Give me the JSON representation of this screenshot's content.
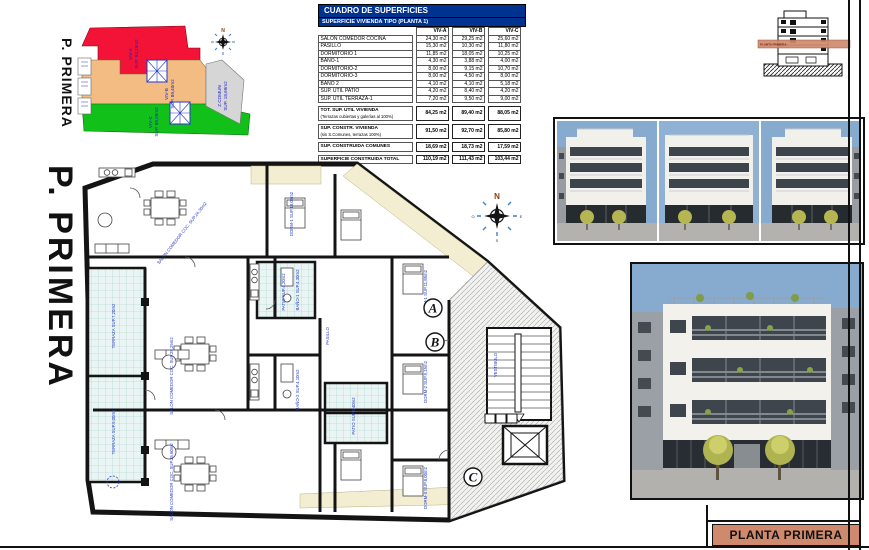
{
  "title_block": {
    "label": "PLANTA PRIMERA"
  },
  "section_thumb": {
    "band_label": "PLANTA PRIMERA"
  },
  "key_plan": {
    "title": "P. PRIMERA",
    "compass_n": "N",
    "zones": [
      {
        "label": "VIV-A",
        "sup": "SUP. 84,25m2",
        "color": "#f31336"
      },
      {
        "label": "VIV-B",
        "sup": "SUP. 89,40m2",
        "color": "#f2bc82"
      },
      {
        "label": "VIV-C",
        "sup": "SUP. 88,05m2",
        "color": "#12c01a"
      },
      {
        "label": "Z.COMUN",
        "sup": "SUP. 18,69m2",
        "color": "#d6d6d6"
      }
    ]
  },
  "areas_table": {
    "title": "CUADRO DE SUPERFICIES",
    "subtitle": "SUPERFICIE VIVIENDA TIPO  (PLANTA 1)",
    "columns": [
      "VIV-A",
      "VIV-B",
      "VIV-C"
    ],
    "rows": [
      {
        "label": "SALON COMEDOR COCINA",
        "a": "24,30 m2",
        "b": "29,25 m2",
        "c": "25,60 m2"
      },
      {
        "label": "PASILLO",
        "a": "15,30 m2",
        "b": "10,30 m2",
        "c": "11,80 m2"
      },
      {
        "label": "DORMITORIO 1",
        "a": "11,85 m2",
        "b": "18,05 m2",
        "c": "10,25 m2"
      },
      {
        "label": "BAÑO-1",
        "a": "4,30 m2",
        "b": "3,88 m2",
        "c": "4,00 m2"
      },
      {
        "label": "DORMITORIO-2",
        "a": "8,00 m2",
        "b": "9,15 m2",
        "c": "10,70 m2"
      },
      {
        "label": "DORMITORIO-3",
        "a": "8,00 m2",
        "b": "4,50 m2",
        "c": "8,00 m2"
      },
      {
        "label": "BAÑO 2",
        "a": "4,10 m2",
        "b": "4,10 m2",
        "c": "5,18 m2"
      },
      {
        "label": "SUP. ÚTIL PATIO",
        "a": "4,20 m2",
        "b": "8,40 m2",
        "c": "4,20 m2"
      },
      {
        "label": "SUP. ÚTIL TERRAZA-1",
        "a": "7,20 m2",
        "b": "9,50 m2",
        "c": "9,00 m2"
      }
    ],
    "summary": [
      {
        "label": "TOT. SUP. UTIL VIVIENDA",
        "note": "(Terrazas cubiertas y galerías al 100%)",
        "a": "84,25 m2",
        "b": "89,40 m2",
        "c": "88,05 m2"
      },
      {
        "label": "SUP. CONSTR. VIVIENDA",
        "note": "(sin S.Comunes, terrazas 100%)",
        "a": "91,50 m2",
        "b": "92,70 m2",
        "c": "85,80 m2"
      },
      {
        "label": "SUP. CONSTRUIDA COMUNES",
        "note": "",
        "a": "18,69 m2",
        "b": "18,73 m2",
        "c": "17,59 m2"
      },
      {
        "label": "SUPERFICIE CONSTRUIDA TOTAL",
        "note": "",
        "a": "110,19 m2",
        "b": "111,43 m2",
        "c": "103,44 m2"
      }
    ]
  },
  "floor_plan": {
    "markers": [
      "A",
      "B",
      "C"
    ],
    "compass": {
      "n": "N",
      "o": "O",
      "e": "E",
      "s": "S"
    },
    "labels": {
      "side_title": "P. PRIMERA",
      "salon_a": "SALON COMEDOR COC. SUP.24,30m2",
      "salon_b": "SALON COMEDOR COC. SUP.29,25m2",
      "salon_c": "SALON COMEDOR COC. SUP.25,60m2",
      "dorm_top": "DORM-1 SUP.18,05m2",
      "dorm1": "DORM-1 SUP.11,85m2",
      "dorm2": "DORM-2 SUP.9,15m2",
      "dorm3": "DORM-3 SUP.8,00m2",
      "bano1": "BAÑO-1 SUP.4,30m2",
      "bano2": "BAÑO-2 SUP.4,10m2",
      "terraza1": "TERRAZA SUP.7,20m2",
      "terraza2": "TERRAZA SUP.9,00m2",
      "patio1": "PATIO SUP.4,20m2",
      "patio2": "PATIO SUP.8,40m2",
      "pasillo": "PASILLO",
      "vestibulo": "VESTIBULO"
    }
  },
  "colors": {
    "table_header_blue": "#00338f",
    "title_block_salmon": "#cf8a6d",
    "zone_red": "#f31336",
    "zone_tan": "#f2bc82",
    "zone_green": "#12c01a",
    "zone_gray": "#d6d6d6",
    "tile_cyan": "#eaf5f3",
    "gallery_cream": "#f3eed2",
    "label_blue": "#2338c8",
    "photo_sky": "#87aacf"
  }
}
